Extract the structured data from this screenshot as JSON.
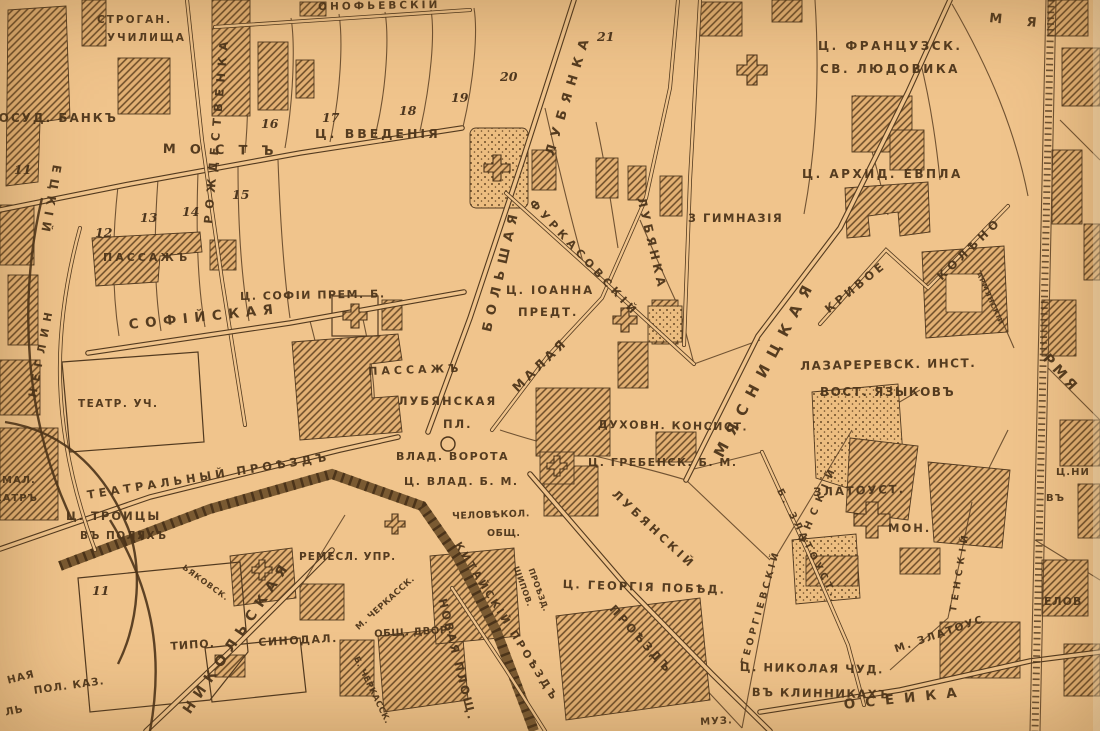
{
  "colors": {
    "paper": "#F0C48C",
    "ink": "#523A20",
    "hatch": "#6B4B27"
  },
  "street_labels": {
    "most": "МОСТЪ",
    "kuznetsky_partial": "ЕЦКІЙ",
    "rozhdestvenka": "РОЖДЕСТВЕНКА",
    "varsonofyevsky_partial": "ОНОФЬЕВСКІЙ",
    "sofiyskaya": "СОФІЙСКАЯ",
    "neglinny_partial": "НЕГЛИН",
    "teatralny_proezd": "ТЕАТРАЛЬНЫЙ ПРОѢЗДЪ",
    "nikolskaya": "НИКОЛЬСКАЯ",
    "bolshaya": "БОЛЬШАЯ",
    "lubyanka_bolshaya": "ЛУБЯНКА",
    "malaya": "МАЛАЯ",
    "lubyanka_malaya": "ЛУБЯНКА",
    "furkasovsky": "ФУРКАСОВСКІЙ",
    "myasnitskaya": "МЯСНИЦКАЯ",
    "krivoe": "КРИВОЕ",
    "koleno": "КОЛѢНО",
    "armyansky": "АРМЯНСКІЙ",
    "kitaysky_proezd": "КИТАЙСКІЙ ПРОѢЗДЪ",
    "novaya_ploshchad": "НОВАЯ ПЛОЩ.",
    "shipov_line1": "ШИПОВ.",
    "shipov_line2": "ПРОѢЗД.",
    "lubyansky": "ЛУБЯНСКІЙ",
    "lubyansky_proezd": "ПРОѢЗДЪ",
    "cherkassky_maly": "М. ЧЕРКАССК.",
    "cherkassky_bolshoy": "Б. ЧЕРКАССК.",
    "tretyakovsky_partial": "ЬЯКОВСК.",
    "georgievsky": "ГЕОРГІЕВСКІЙ",
    "ensky_partial": "ЕНСКІЙ",
    "zlatoust_bolshoy": "Б. ЗЛАТОУСТ.",
    "zlatoust_maly": "М. ЗЛАТОУС",
    "tensky_partial": "ТЕНСКІЙ",
    "maroseyka_partial": "ОСЕЙКА",
    "rmya_partial": "РМЯ",
    "mya_partial": "М Я"
  },
  "poi_labels": {
    "stroganov_line1": "СТРОГАН.",
    "stroganov_line2": "УЧИЛИЩА",
    "gosud_bank": "ГОСУД. БАНКЪ",
    "passazh_kuznetsky": "ПАССАЖЪ",
    "ts_vvedeniya": "Ц. ВВЕДЕНІЯ",
    "ts_frantsuzsk_line1": "Ц. ФРАНЦУЗСК.",
    "ts_frantsuzsk_line2": "СВ. ЛЮДОВИКА",
    "ts_arkhid_evpla": "Ц. АРХИД. ЕВПЛА",
    "gimnaziya": "3 ГИМНАЗІЯ",
    "ts_sofii": "Ц. СОФІИ ПРЕМ. Б.",
    "ts_ioanna_line1": "Ц. ІОАННА",
    "ts_ioanna_line2": "ПРЕДТ.",
    "teatr_uchilishche": "ТЕАТР. УЧ.",
    "maly_teatr_line1": "МАЛ.",
    "maly_teatr_line2": "ТЕАТРЪ",
    "passazh_lubyansky": "ПАССАЖЪ",
    "lubyanskaya_pl_line1": "ЛУБЯНСКАЯ",
    "lubyanskaya_pl_line2": "ПЛ.",
    "vlad_vorota": "ВЛАД. ВОРОТА",
    "ts_vlad": "Ц. ВЛАД. Б. М.",
    "dukhovnaya_konsistoriya": "ДУХОВН. КОНСИСТ.",
    "ts_grebensk": "Ц. ГРЕБЕНСК. Б. М.",
    "lazarevsky_line1": "ЛАЗАРЕРЕВСК. ИНСТ.",
    "lazarevsky_line2": "ВОСТ. ЯЗЫКОВЪ",
    "ts_troitsy_line1": "Ц. ТРОИЦЫ",
    "ts_troitsy_line2": "ВЪ ПОЛЯХЪ",
    "remeslennaya_uprava": "РЕМЕСЛ. УПР.",
    "tipografiya": "ТИПО.",
    "sinodal": "СИНОДАЛ.",
    "obshchy_dvor": "ОБЩ. ДВОР.",
    "chelovekolub_line1": "ЧЕЛОВѢКОЛ.",
    "chelovekolub_line2": "ОБЩ.",
    "ts_georgiya": "Ц. ГЕОРГІЯ ПОБѢД.",
    "zlatoust_mon_line1": "ЗЛАТОУСТ.",
    "zlatoust_mon_line2": "МОН.",
    "ts_nikolaya_line1": "Ц. НИКОЛАЯ ЧУД.",
    "ts_nikolaya_line2": "ВЪ КЛИННИКАХЪ",
    "pol_kaz": "ПОЛ. КАЗ.",
    "naya_partial": "НАЯ",
    "l_partial": "ЛЬ",
    "ts_ni_partial": "Ц.НИ",
    "vu_partial": "ВЪ",
    "elov_partial": "ЕЛОВ",
    "muz_partial": "МУЗ."
  },
  "plot_numbers": {
    "n11": "11",
    "n12": "12",
    "n13": "13",
    "n14": "14",
    "n15": "15",
    "n16": "16",
    "n17": "17",
    "n18": "18",
    "n19": "19",
    "n20": "20",
    "n21": "21",
    "n11_south": "11"
  }
}
